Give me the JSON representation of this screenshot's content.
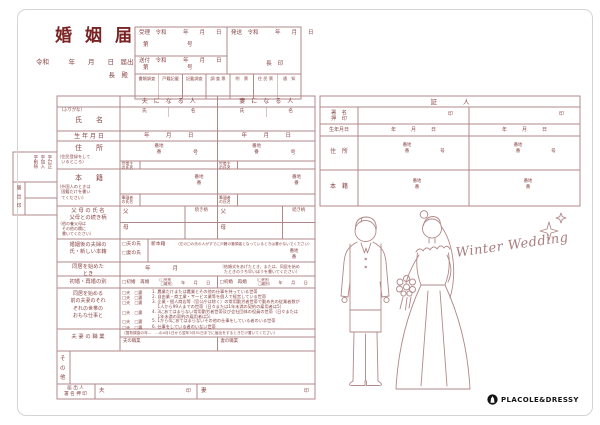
{
  "header": {
    "title": "婚姻届",
    "date_line": "令和　　　年　　月　　日　届出",
    "addressee": "長　殿"
  },
  "office": {
    "juri_line": "受理　令和　　　年　　月　　日",
    "daigo": "第　　　　　　　号",
    "hasso_line": "発送　令和　　　年　　月　　日",
    "mayor_seal": "長　印",
    "sofu_line": "送付　令和　　　年　　月　　日",
    "cols": [
      "書類調査",
      "戸籍記載",
      "記載調査",
      "調 査 票",
      "附　票",
      "住 民 票",
      "通　知"
    ]
  },
  "correction": {
    "lines": [
      "字訂正",
      "字加入",
      "字削除"
    ],
    "side": "届\n出\n印"
  },
  "main": {
    "husband_header": "夫　に　な　る　人",
    "wife_header": "妻　に　な　る　人",
    "furigana": "（ふりがな）",
    "name_label": "氏　　名",
    "sei": "氏",
    "mei": "名",
    "birth_label": "生 年 月 日",
    "birth_value": "年　　　月　　　日",
    "address_label": "住　　所",
    "address_note": "（住民登録をして\n　いるところ）",
    "banchi_ban": "番地\n番",
    "go": "号",
    "setainushi": "世帯主\nの氏名",
    "honseki_label": "本　　籍",
    "honseki_note": "（外国人のときは\n　国籍だけを書い\n　てください）",
    "hittousha": "筆頭者\nの氏名",
    "parents_label": "父 母 の 氏 名\n父母との続き柄",
    "parents_note": "（他の養父母は\n　その他の欄に\n　書いてください）",
    "father": "父",
    "mother": "母",
    "tsuzukigara": "続き柄",
    "after_label": "婚姻後の夫婦の\n氏・新しい本籍",
    "cb_husband_shi": "□夫の氏",
    "cb_wife_shi": "□妻の氏",
    "shinhonseki": "新本籍",
    "after_note": "（左の□の氏の人がすでに戸籍の筆頭者となっているときは書かないでください）",
    "cohabit_label": "同居を始めた\nとき",
    "cohabit_value": "年　　　　月",
    "cohabit_note": "（結婚式をあげたとき、または、同居を始め\n　たときのうち早いほうを書いてください）",
    "marriage_label": "初婚・再婚の別",
    "marriage_cb": "□初婚　再婚",
    "marriage_sub": "（□死別\n　□離別）",
    "marriage_ymd": "年　　月　　日",
    "work_label": "同居を始める\n前の夫妻のそれ\nぞれの世帯の\nおもな仕事と",
    "work_cb": "□夫　□妻",
    "work_items": [
      "1. 農業だけまたは農業とその他の仕事を持っている世帯",
      "2. 自由業・商工業・サービス業等を個人で経営している世帯",
      "3. 企業・個人商店等（官公庁は除く）の常用勤労者世帯で勤め先の従業者数が\n　 1人から99人までの世帯（日々または1年未満の契約の雇用者は5）",
      "4. 3にあてはまらない常用勤労者世帯及び会社団体の役員の世帯（日々または\n　 1年未満の契約の雇用者は5）",
      "5. 1から4にあてはまらないその他の仕事をしている者のいる世帯",
      "6. 仕事をしている者のいない世帯"
    ],
    "occupation_label": "夫 妻 の 職 業",
    "occupation_note": "（国勢調査の年…　…の4月1日から翌年3月31日までに届出をするときだけ書いてください）",
    "husband_job": "夫の職業",
    "wife_job": "妻の職業",
    "other_label": "そ\nの\n他",
    "sign_label": "届 出 人\n署 名 押 印",
    "sign_husband": "夫",
    "sign_wife": "妻",
    "seal": "印"
  },
  "witness": {
    "header": "証　　　　人",
    "sign_label": "署　名\n押　印",
    "seal": "印",
    "birth_label": "生年月日",
    "birth_value": "年　　　月　　　日",
    "address_label": "住　所",
    "honseki_label": "本　籍",
    "banchi_ban": "番地\n番",
    "go": "号"
  },
  "art": {
    "caption": "Winter Wedding"
  },
  "brand": {
    "name": "PLACOLE&DRESSY"
  },
  "colors": {
    "ink": "#8a4545",
    "line": "#b08585",
    "accent_dark": "#7a2424"
  }
}
